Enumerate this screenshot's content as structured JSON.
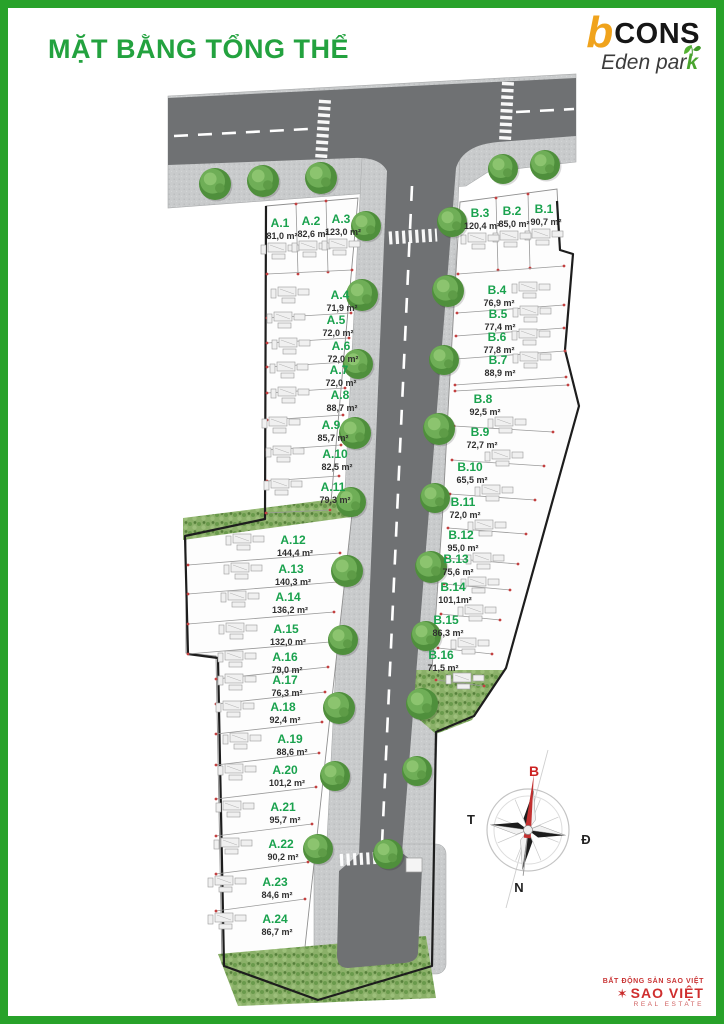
{
  "page_title": "MẶT BẰNG TỔNG THỂ",
  "brand": {
    "logo_b": "b",
    "logo_cons": "CONS",
    "logo_sub_main": "Eden par",
    "logo_sub_k": "k"
  },
  "compass": {
    "north": "B",
    "west": "T",
    "east": "Đ",
    "south": "N"
  },
  "footer": {
    "tagline": "BẤT ĐỘNG SẢN SAO VIỆT",
    "glyph": "✶",
    "brand": "SAO VIỆT",
    "subtitle": "REAL ESTATE"
  },
  "colors": {
    "border_green": "#28a22a",
    "title_green": "#23a23f",
    "lot_label_green": "#1aa24e",
    "road_gray": "#6f7173",
    "sidewalk_gray": "#c9cbcc",
    "brand_orange": "#f0a31c",
    "footer_red": "#cf2e2e"
  },
  "lots": {
    "a": [
      {
        "id": "A.1",
        "area": "81,0 m²"
      },
      {
        "id": "A.2",
        "area": "82,6 m²"
      },
      {
        "id": "A.3",
        "area": "123,0 m²"
      },
      {
        "id": "A.4",
        "area": "71,9 m²"
      },
      {
        "id": "A.5",
        "area": "72,0 m²"
      },
      {
        "id": "A.6",
        "area": "72,0 m²"
      },
      {
        "id": "A.7",
        "area": "72,0 m²"
      },
      {
        "id": "A.8",
        "area": "88,7 m²"
      },
      {
        "id": "A.9",
        "area": "85,7 m²"
      },
      {
        "id": "A.10",
        "area": "82,5 m²"
      },
      {
        "id": "A.11",
        "area": "79,3 m²"
      },
      {
        "id": "A.12",
        "area": "144,4 m²"
      },
      {
        "id": "A.13",
        "area": "140,3 m²"
      },
      {
        "id": "A.14",
        "area": "136,2 m²"
      },
      {
        "id": "A.15",
        "area": "132,0 m²"
      },
      {
        "id": "A.16",
        "area": "79,0 m²"
      },
      {
        "id": "A.17",
        "area": "76,3 m²"
      },
      {
        "id": "A.18",
        "area": "92,4 m²"
      },
      {
        "id": "A.19",
        "area": "88,6 m²"
      },
      {
        "id": "A.20",
        "area": "101,2 m²"
      },
      {
        "id": "A.21",
        "area": "95,7 m²"
      },
      {
        "id": "A.22",
        "area": "90,2 m²"
      },
      {
        "id": "A.23",
        "area": "84,6 m²"
      },
      {
        "id": "A.24",
        "area": "86,7 m²"
      }
    ],
    "b": [
      {
        "id": "B.1",
        "area": "90,7 m²"
      },
      {
        "id": "B.2",
        "area": "85,0 m²"
      },
      {
        "id": "B.3",
        "area": "120,4 m²"
      },
      {
        "id": "B.4",
        "area": "76,9 m²"
      },
      {
        "id": "B.5",
        "area": "77,4 m²"
      },
      {
        "id": "B.6",
        "area": "77,8 m²"
      },
      {
        "id": "B.7",
        "area": "88,9 m²"
      },
      {
        "id": "B.8",
        "area": "92,5 m²"
      },
      {
        "id": "B.9",
        "area": "72,7 m²"
      },
      {
        "id": "B.10",
        "area": "65,5 m²"
      },
      {
        "id": "B.11",
        "area": "72,0 m²"
      },
      {
        "id": "B.12",
        "area": "95,0 m²"
      },
      {
        "id": "B.13",
        "area": "75,6 m²"
      },
      {
        "id": "B.14",
        "area": "101,1m²"
      },
      {
        "id": "B.15",
        "area": "86,3 m²"
      },
      {
        "id": "B.16",
        "area": "71,5 m²"
      }
    ]
  }
}
